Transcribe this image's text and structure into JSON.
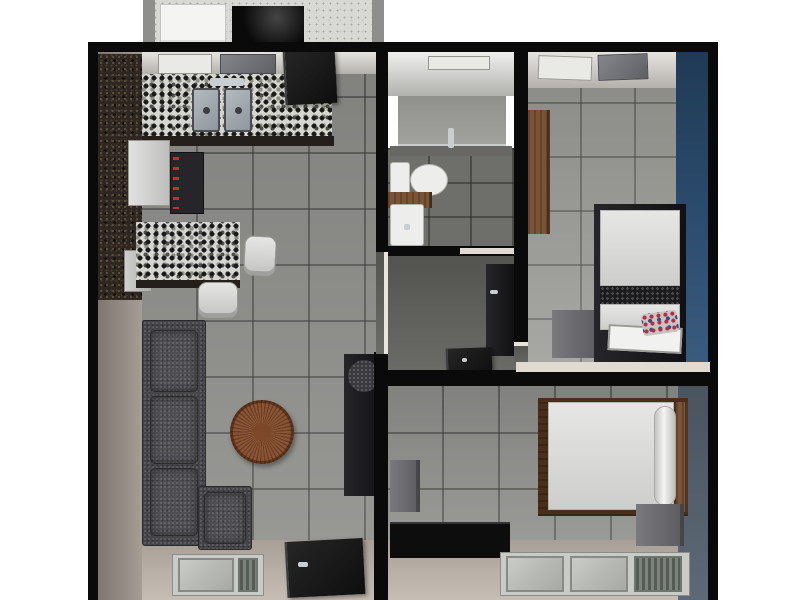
{
  "meta": {
    "view": "apartment-3d-floor-plan-top-view",
    "canvas_width": 800,
    "canvas_height": 600
  },
  "palette": {
    "background": "#ffffff",
    "wall_black": "#0b0a0a",
    "floor_tile_gray": "#8f8f8c",
    "bedroom1_accent_wall_blue": "#2e4f72",
    "bedroom2_wall_bluegray": "#5d6977",
    "wall_face_beige": "#b5ada5",
    "granite_dark_counter": "#2e2620",
    "granite_mosaic_counter": "#d6d6d0",
    "sofa_gray": "#46464a",
    "table_wood_brown": "#8a5436",
    "wood_brown": "#7a5434",
    "fixture_white": "#ededeb"
  },
  "rooms": [
    {
      "name": "service-balcony"
    },
    {
      "name": "kitchen"
    },
    {
      "name": "living-room"
    },
    {
      "name": "bathroom"
    },
    {
      "name": "hallway-closet"
    },
    {
      "name": "bedroom-1"
    },
    {
      "name": "bedroom-2"
    }
  ],
  "scene": {
    "objects": [
      {
        "name": "service-area-floor",
        "cls": "speckle-light",
        "rect": [
          145,
          0,
          233,
          44
        ]
      },
      {
        "name": "service-pillar-left",
        "cls": "pillar",
        "rect": [
          143,
          0,
          12,
          44
        ]
      },
      {
        "name": "service-pillar-right",
        "cls": "pillar",
        "rect": [
          372,
          0,
          12,
          44
        ]
      },
      {
        "name": "washing-machine-white",
        "cls": "appliance-white",
        "rect": [
          160,
          4,
          66,
          40
        ]
      },
      {
        "name": "laundry-unit-black",
        "cls": "appliance-black",
        "rect": [
          232,
          6,
          72,
          38
        ]
      },
      {
        "name": "living-wall-face-left",
        "cls": "wallface-left",
        "rect": [
          98,
          52,
          44,
          548
        ]
      },
      {
        "name": "living-floor-tiles",
        "cls": "tile-floor",
        "rect": [
          142,
          52,
          234,
          548
        ]
      },
      {
        "name": "living-wall-face-bottom",
        "cls": "wallface-bottom",
        "rect": [
          142,
          540,
          234,
          60
        ]
      },
      {
        "name": "kitchen-ceiling-band",
        "cls": "ceil-band",
        "rect": [
          142,
          52,
          234,
          22
        ]
      },
      {
        "name": "kitchen-ceiling-vent-1",
        "cls": "vent-light",
        "rect": [
          158,
          54,
          54,
          20
        ]
      },
      {
        "name": "kitchen-ceiling-vent-2",
        "cls": "vent-dark",
        "rect": [
          220,
          54,
          56,
          20
        ]
      },
      {
        "name": "kitchen-tall-cabinet-granite",
        "cls": "granite-dark",
        "rect": [
          98,
          54,
          44,
          246
        ]
      },
      {
        "name": "kitchen-counter-mosaic",
        "cls": "granite-mosaic",
        "rect": [
          142,
          74,
          190,
          64
        ]
      },
      {
        "name": "kitchen-counter-edge",
        "cls": "edge-dark",
        "rect": [
          142,
          136,
          192,
          10
        ]
      },
      {
        "name": "kitchen-sink-basin-left",
        "cls": "sink",
        "rect": [
          192,
          88,
          28,
          44
        ]
      },
      {
        "name": "kitchen-sink-basin-right",
        "cls": "sink",
        "rect": [
          224,
          88,
          28,
          44
        ]
      },
      {
        "name": "kitchen-sink-faucet",
        "cls": "metal",
        "rect": [
          210,
          78,
          34,
          8
        ]
      },
      {
        "name": "fridge",
        "cls": "appliance-light",
        "rect": [
          128,
          140,
          42,
          66
        ]
      },
      {
        "name": "stove-range",
        "cls": "stove",
        "rect": [
          170,
          152,
          34,
          62
        ]
      },
      {
        "name": "dishwasher-cart",
        "cls": "appliance-light2",
        "rect": [
          124,
          250,
          28,
          42
        ]
      },
      {
        "name": "kitchen-peninsula-mosaic",
        "cls": "granite-mosaic",
        "rect": [
          136,
          222,
          104,
          62
        ]
      },
      {
        "name": "kitchen-peninsula-edge",
        "cls": "edge-dark",
        "rect": [
          136,
          280,
          104,
          8
        ]
      },
      {
        "name": "bar-chair-1",
        "cls": "chair",
        "rect": [
          244,
          236,
          32,
          40
        ],
        "rot": 3
      },
      {
        "name": "bar-chair-2",
        "cls": "chair",
        "rect": [
          198,
          282,
          40,
          36
        ]
      },
      {
        "name": "sofa-main",
        "cls": "sofa",
        "rect": [
          142,
          320,
          64,
          226
        ]
      },
      {
        "name": "sofa-cushion-1",
        "cls": "sofa-cushion",
        "rect": [
          150,
          330,
          48,
          62
        ]
      },
      {
        "name": "sofa-cushion-2",
        "cls": "sofa-cushion",
        "rect": [
          150,
          396,
          48,
          68
        ]
      },
      {
        "name": "sofa-cushion-3",
        "cls": "sofa-cushion",
        "rect": [
          150,
          468,
          48,
          68
        ]
      },
      {
        "name": "sofa-corner-seat",
        "cls": "sofa",
        "rect": [
          198,
          486,
          54,
          64
        ]
      },
      {
        "name": "sofa-corner-cushion",
        "cls": "sofa-cushion",
        "rect": [
          204,
          492,
          42,
          52
        ]
      },
      {
        "name": "coffee-table-round-wood",
        "cls": "table-round",
        "rect": [
          230,
          400,
          64,
          64
        ]
      },
      {
        "name": "tv-cabinet",
        "cls": "unit-dark",
        "rect": [
          344,
          354,
          40,
          142
        ]
      },
      {
        "name": "tv-cabinet-disc",
        "cls": "disc-speckle",
        "rect": [
          348,
          360,
          32,
          32
        ]
      },
      {
        "name": "living-window-frame",
        "cls": "window-frame",
        "rect": [
          172,
          554,
          92,
          42
        ]
      },
      {
        "name": "living-window-pane-large",
        "cls": "pane",
        "rect": [
          178,
          558,
          56,
          34
        ]
      },
      {
        "name": "living-window-pane-small",
        "cls": "pane-dark",
        "rect": [
          238,
          558,
          20,
          34
        ]
      },
      {
        "name": "entrance-door",
        "cls": "door-dark",
        "rect": [
          286,
          540,
          78,
          56
        ],
        "rot": -3
      },
      {
        "name": "entrance-door-handle",
        "cls": "metal",
        "rect": [
          298,
          562,
          10,
          5
        ]
      },
      {
        "name": "kitchen-open-door-panel",
        "cls": "door-dark",
        "rect": [
          284,
          50,
          52,
          54
        ],
        "rot": -3
      },
      {
        "name": "bathroom-ceiling",
        "cls": "bath-ceil",
        "rect": [
          388,
          50,
          128,
          46
        ]
      },
      {
        "name": "bathroom-ceiling-vent",
        "cls": "vent-light",
        "rect": [
          428,
          56,
          62,
          14
        ]
      },
      {
        "name": "shower-back-wall",
        "cls": "bath-wall",
        "rect": [
          398,
          96,
          108,
          50
        ]
      },
      {
        "name": "shower-glass-partition",
        "cls": "glass",
        "rect": [
          398,
          144,
          108,
          4
        ]
      },
      {
        "name": "bathroom-floor",
        "cls": "bath-floor",
        "rect": [
          388,
          148,
          128,
          102
        ]
      },
      {
        "name": "bathroom-ledge",
        "cls": "bath-ledge",
        "rect": [
          390,
          146,
          122,
          10
        ]
      },
      {
        "name": "shower-faucet",
        "cls": "metal",
        "rect": [
          448,
          128,
          6,
          20
        ]
      },
      {
        "name": "toilet-tank",
        "cls": "white-fixture",
        "rect": [
          390,
          162,
          20,
          36
        ]
      },
      {
        "name": "toilet-bowl",
        "cls": "white-fixture toilet-bowl",
        "rect": [
          410,
          164,
          38,
          32
        ]
      },
      {
        "name": "vanity-counter-wood",
        "cls": "wood",
        "rect": [
          388,
          192,
          44,
          16
        ]
      },
      {
        "name": "vanity-basin",
        "cls": "white-fixture",
        "rect": [
          390,
          204,
          34,
          42
        ]
      },
      {
        "name": "vanity-faucet",
        "cls": "metal",
        "rect": [
          404,
          224,
          6,
          6
        ]
      },
      {
        "name": "hallway-floor",
        "cls": "floor-dark",
        "rect": [
          388,
          256,
          126,
          118
        ]
      },
      {
        "name": "hallway-wardrobe",
        "cls": "unit-dark",
        "rect": [
          486,
          264,
          28,
          92
        ]
      },
      {
        "name": "hallway-wardrobe-handle",
        "cls": "metal",
        "rect": [
          490,
          290,
          8,
          4
        ]
      },
      {
        "name": "hallway-open-door",
        "cls": "door-dark",
        "rect": [
          446,
          348,
          46,
          26
        ],
        "rot": -2
      },
      {
        "name": "hallway-door-handle",
        "cls": "metal",
        "rect": [
          462,
          358,
          5,
          4
        ]
      },
      {
        "name": "bedroom1-floor-tiles",
        "cls": "tile-floor-light",
        "rect": [
          528,
          52,
          148,
          320
        ]
      },
      {
        "name": "bedroom1-ceiling-band",
        "cls": "ceil-band",
        "rect": [
          528,
          52,
          148,
          36
        ]
      },
      {
        "name": "bedroom1-ceiling-vent-1",
        "cls": "vent-light",
        "rect": [
          538,
          56,
          54,
          24
        ],
        "rot": 2
      },
      {
        "name": "bedroom1-ceiling-vent-2",
        "cls": "vent-dark",
        "rect": [
          598,
          54,
          50,
          26
        ],
        "rot": -2
      },
      {
        "name": "bedroom1-accent-wall-blue",
        "cls": "wall-blue",
        "rect": [
          676,
          52,
          32,
          320
        ]
      },
      {
        "name": "bedroom1-wardrobe-wood",
        "cls": "wood",
        "rect": [
          528,
          110,
          22,
          124
        ]
      },
      {
        "name": "bedroom1-nightstand",
        "cls": "unit-gray",
        "rect": [
          552,
          310,
          46,
          48
        ]
      },
      {
        "name": "bedroom1-bed-frame",
        "cls": "unit-dark",
        "rect": [
          594,
          204,
          92,
          162
        ]
      },
      {
        "name": "bedroom1-bed-duvet",
        "cls": "white-soft",
        "rect": [
          600,
          210,
          80,
          76
        ]
      },
      {
        "name": "bedroom1-bed-blanket-band",
        "cls": "speckle-black",
        "rect": [
          600,
          286,
          80,
          18
        ]
      },
      {
        "name": "bedroom1-bed-foot-sheet",
        "cls": "white-soft",
        "rect": [
          600,
          304,
          80,
          26
        ]
      },
      {
        "name": "bedroom1-bed-tray",
        "cls": "tray",
        "rect": [
          608,
          326,
          74,
          26
        ],
        "rot": 3
      },
      {
        "name": "bedroom1-patterned-pillow",
        "cls": "pillow-multi",
        "rect": [
          642,
          312,
          36,
          22
        ],
        "rot": -8
      },
      {
        "name": "bedroom2-floor-tiles",
        "cls": "tile-floor",
        "rect": [
          388,
          384,
          322,
          160
        ]
      },
      {
        "name": "bedroom2-wall-face-bottom",
        "cls": "wallface-bottom",
        "rect": [
          388,
          540,
          322,
          60
        ]
      },
      {
        "name": "bedroom2-right-wall-bluegray",
        "cls": "wall-bluegray",
        "rect": [
          678,
          384,
          30,
          216
        ]
      },
      {
        "name": "bedroom2-wall-tv",
        "cls": "unit-gray",
        "rect": [
          390,
          460,
          30,
          52
        ]
      },
      {
        "name": "bedroom2-dresser-black",
        "cls": "unit-black",
        "rect": [
          390,
          522,
          120,
          36
        ]
      },
      {
        "name": "bedroom2-bed-frame-wood",
        "cls": "wood-dark",
        "rect": [
          538,
          398,
          150,
          118
        ]
      },
      {
        "name": "bedroom2-mattress",
        "cls": "white-soft",
        "rect": [
          548,
          402,
          126,
          108
        ]
      },
      {
        "name": "bedroom2-pillow-roll",
        "cls": "pillow-roll",
        "rect": [
          654,
          406,
          22,
          100
        ]
      },
      {
        "name": "bedroom2-headboard-wood",
        "cls": "wood",
        "rect": [
          676,
          402,
          12,
          110
        ]
      },
      {
        "name": "bedroom2-nightstand",
        "cls": "unit-gray",
        "rect": [
          636,
          504,
          48,
          42
        ]
      },
      {
        "name": "bedroom2-window-frame",
        "cls": "window-frame",
        "rect": [
          500,
          552,
          190,
          44
        ]
      },
      {
        "name": "bedroom2-window-pane-1",
        "cls": "pane",
        "rect": [
          506,
          556,
          58,
          36
        ]
      },
      {
        "name": "bedroom2-window-pane-2",
        "cls": "pane",
        "rect": [
          570,
          556,
          58,
          36
        ]
      },
      {
        "name": "bedroom2-window-pane-mesh",
        "cls": "pane-dark",
        "rect": [
          634,
          556,
          48,
          36
        ]
      },
      {
        "name": "wall-top",
        "cls": "wall",
        "rect": [
          88,
          42,
          630,
          10
        ]
      },
      {
        "name": "wall-left",
        "cls": "wall",
        "rect": [
          88,
          42,
          10,
          558
        ]
      },
      {
        "name": "wall-right",
        "cls": "wall",
        "rect": [
          708,
          42,
          10,
          558
        ]
      },
      {
        "name": "wall-bathroom-left",
        "cls": "wall",
        "rect": [
          376,
          48,
          12,
          204
        ]
      },
      {
        "name": "wall-bathroom-bottom",
        "cls": "wall",
        "rect": [
          376,
          246,
          140,
          10
        ]
      },
      {
        "name": "bathroom-door-jamb",
        "cls": "cream-strip",
        "rect": [
          460,
          248,
          54,
          6
        ]
      },
      {
        "name": "wall-bedroom1-left",
        "cls": "wall",
        "rect": [
          514,
          48,
          14,
          294
        ]
      },
      {
        "name": "bedroom1-doorway-floor",
        "cls": "floor-dark",
        "rect": [
          514,
          342,
          14,
          30
        ]
      },
      {
        "name": "bedroom1-doorway-jamb",
        "cls": "jamb",
        "rect": [
          514,
          342,
          14,
          4
        ]
      },
      {
        "name": "wall-mid-lower",
        "cls": "wall",
        "rect": [
          374,
          352,
          14,
          248
        ]
      },
      {
        "name": "wall-hallway-bottom",
        "cls": "wall",
        "rect": [
          374,
          370,
          142,
          16
        ]
      },
      {
        "name": "bedrooms-divider-cream-top",
        "cls": "cream-strip",
        "rect": [
          516,
          362,
          194,
          12
        ]
      },
      {
        "name": "bedrooms-divider-wall",
        "cls": "wall",
        "rect": [
          516,
          372,
          194,
          14
        ]
      },
      {
        "name": "living-hallway-doorway-floor",
        "cls": "floor-dark",
        "rect": [
          376,
          252,
          12,
          102
        ]
      },
      {
        "name": "living-hallway-doorway-jamb",
        "cls": "jamb",
        "rect": [
          384,
          252,
          4,
          102
        ]
      }
    ]
  }
}
